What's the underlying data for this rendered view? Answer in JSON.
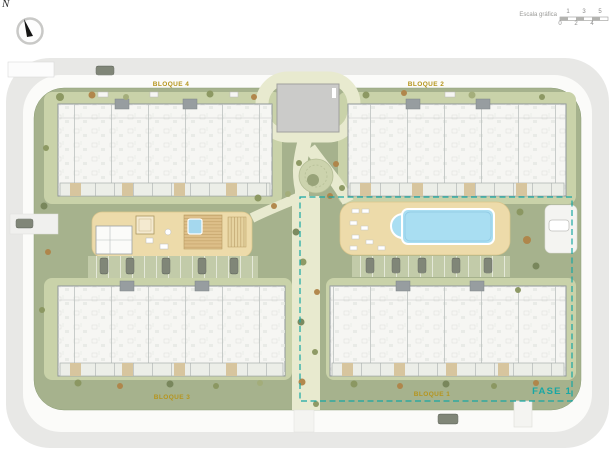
{
  "compass": {
    "north": "N"
  },
  "scale_bar": {
    "label": "Escala gráfica",
    "ticks_top": [
      "1",
      "3",
      "5"
    ],
    "ticks_bottom": [
      "0",
      "2",
      "4"
    ]
  },
  "blocks": {
    "b1": {
      "label": "BLOQUE 1",
      "position": "bottom-right"
    },
    "b2": {
      "label": "BLOQUE 2",
      "position": "top-right"
    },
    "b3": {
      "label": "BLOQUE 3",
      "position": "bottom-left"
    },
    "b4": {
      "label": "BLOQUE 4",
      "position": "top-left"
    }
  },
  "phase": {
    "label": "FASE 1"
  },
  "colors": {
    "site_green": "#a6b28d",
    "light_green": "#c9d2a9",
    "path_cream": "#e8eacf",
    "deck_sand": "#eddbaa",
    "pool_blue": "#a9def2",
    "road_gray": "#e8e8e6",
    "building_fill": "#f6f6f3",
    "label_gold": "#b5951e",
    "phase_teal": "#18a7a4"
  }
}
